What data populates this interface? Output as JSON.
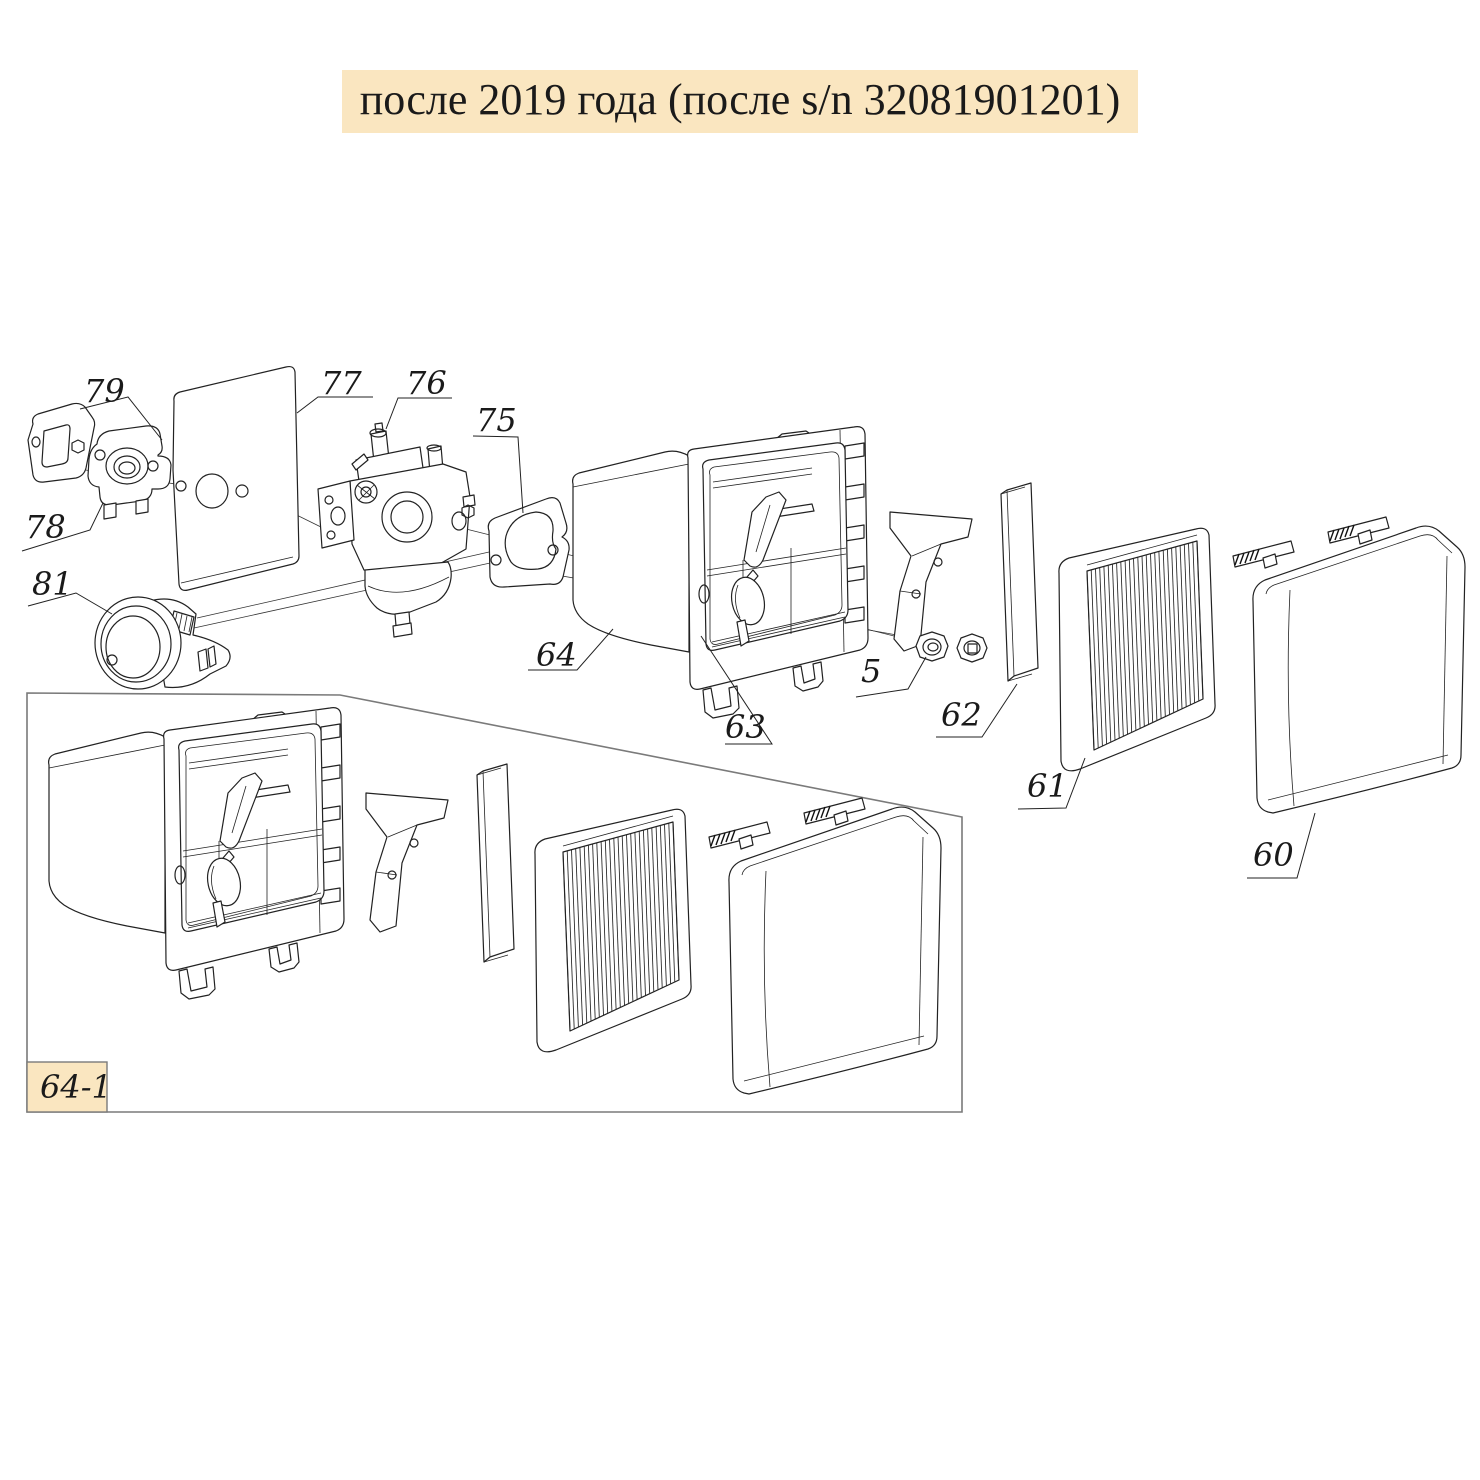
{
  "title": {
    "text": "после 2019 года (после s/n 32081901201)"
  },
  "colors": {
    "highlight": "#fae6c0",
    "line": "#222222",
    "inset_border": "#7a7a7a",
    "background": "#ffffff"
  },
  "callouts": [
    {
      "label": "79"
    },
    {
      "label": "78"
    },
    {
      "label": "81"
    },
    {
      "label": "77"
    },
    {
      "label": "76"
    },
    {
      "label": "75"
    },
    {
      "label": "64"
    },
    {
      "label": "63"
    },
    {
      "label": "5"
    },
    {
      "label": "62"
    },
    {
      "label": "61"
    },
    {
      "label": "60"
    }
  ],
  "inset": {
    "label": "64-1"
  }
}
